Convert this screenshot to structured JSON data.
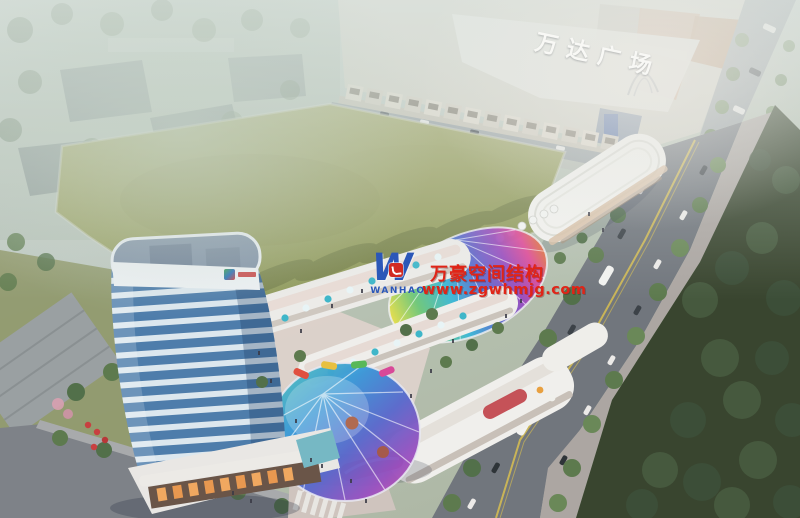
{
  "meta": {
    "description": "Aerial architectural rendering: new mixed-use commercial complex with a blue high-rise tower, iridescent membrane canopies and landscaped plaza, beside a large green field, the Wanda Plaza mall and a tree-lined arterial road",
    "canvas": {
      "width": 800,
      "height": 518
    }
  },
  "signage": {
    "mall_roof_sign": "万达广场"
  },
  "watermark": {
    "monogram": "W",
    "brand": "WANHAO",
    "title": "万豪空间结构",
    "url": "www.zgwhmjg.com",
    "colors": {
      "red": "#e02417",
      "blue": "#2b57b8"
    }
  },
  "palette": {
    "haze": "#ccd6cf",
    "field_green": "#a2a669",
    "road_gray": "#787d83",
    "tree_dark": "#3c4e38",
    "tree_light": "#5d7a4e",
    "tower_glass": "#4e7dab",
    "tower_band": "#dce7ee",
    "building_white": "#f0efeb",
    "plaza_paving": "#ddd2cb",
    "wanda_roof_terracotta": "#c79e82",
    "canopy_rainbow": [
      "#e8e04a",
      "#6ec87a",
      "#3ab8d8",
      "#5a6ad0",
      "#9a4ac0",
      "#e04898"
    ],
    "umbrella_teal": "#3fb6c9",
    "umbrella_red": "#c84040",
    "sign_white": "#fafaf7"
  }
}
